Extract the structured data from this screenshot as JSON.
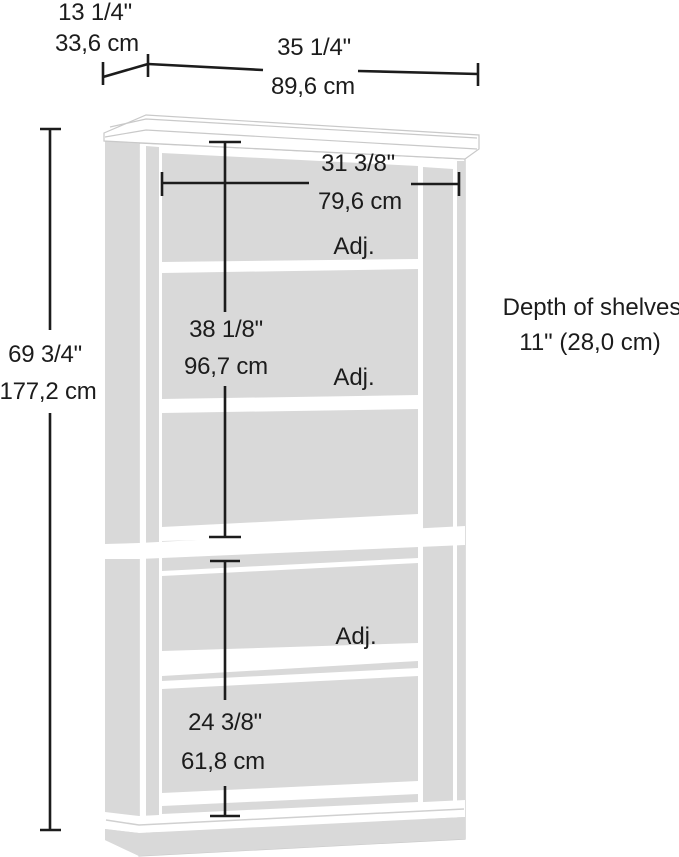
{
  "diagram": {
    "title": "5-shelf bookcase dimension diagram",
    "colors": {
      "panel_fill": "#d9d9d9",
      "dimension_line": "#1c1c1c",
      "edge_line": "#c9c9c9",
      "background": "#ffffff"
    },
    "dimensions": {
      "top_depth": {
        "inches": "13 1/4\"",
        "metric": "33,6 cm"
      },
      "top_width": {
        "inches": "35 1/4\"",
        "metric": "89,6 cm"
      },
      "inner_width": {
        "inches": "31 3/8\"",
        "metric": "79,6 cm"
      },
      "overall_height": {
        "inches": "69 3/4\"",
        "metric": "177,2 cm"
      },
      "upper_section_height": {
        "inches": "38 1/8\"",
        "metric": "96,7 cm"
      },
      "lower_section_height": {
        "inches": "24 3/8\"",
        "metric": "61,8 cm"
      }
    },
    "shelf_labels": {
      "adjustable_1": "Adj.",
      "adjustable_2": "Adj.",
      "adjustable_3": "Adj."
    },
    "notes": {
      "shelf_depth_line1": "Depth of shelves",
      "shelf_depth_line2": "11\" (28,0 cm)"
    }
  }
}
